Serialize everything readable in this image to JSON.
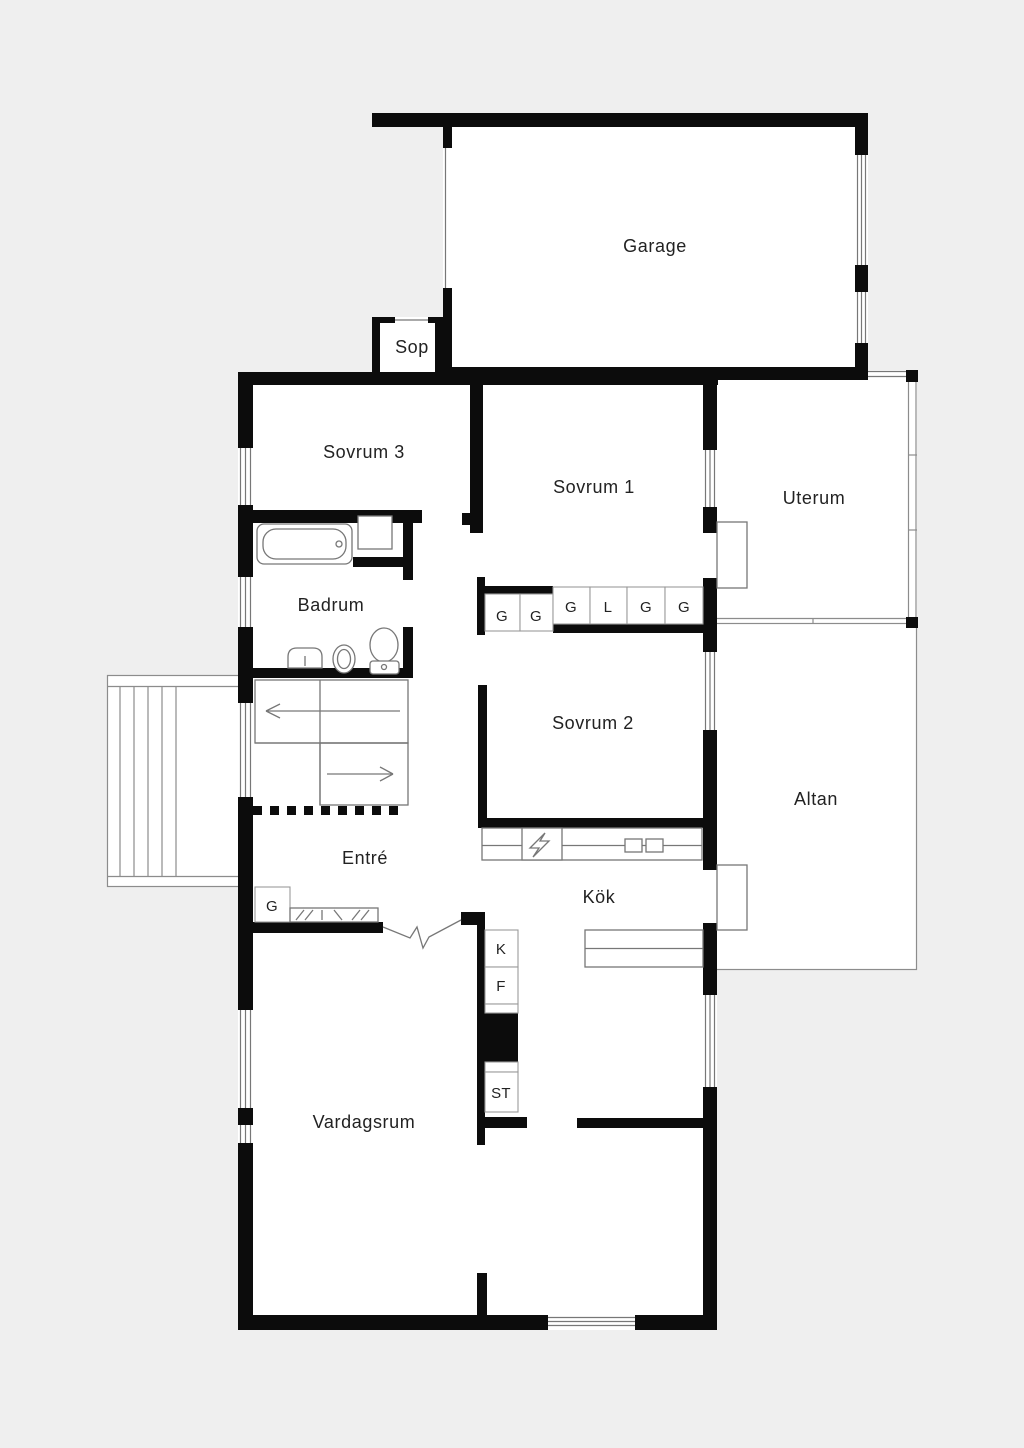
{
  "plan": {
    "rooms": {
      "garage": "Garage",
      "sop": "Sop",
      "sovrum3": "Sovrum 3",
      "sovrum1": "Sovrum 1",
      "uterum": "Uterum",
      "badrum": "Badrum",
      "sovrum2": "Sovrum 2",
      "altan": "Altan",
      "entre": "Entré",
      "kok": "Kök",
      "vardagsrum": "Vardagsrum"
    },
    "wardrobes": {
      "row": [
        "G",
        "G",
        "G",
        "L",
        "G",
        "G"
      ],
      "hall": "G"
    },
    "appliances": {
      "fridge": "K",
      "freezer": "F",
      "cleaning": "ST"
    },
    "colors": {
      "background": "#efefef",
      "wall": "#0c0c0c",
      "floor": "#ffffff",
      "thin_line": "#8c8c8c"
    }
  }
}
